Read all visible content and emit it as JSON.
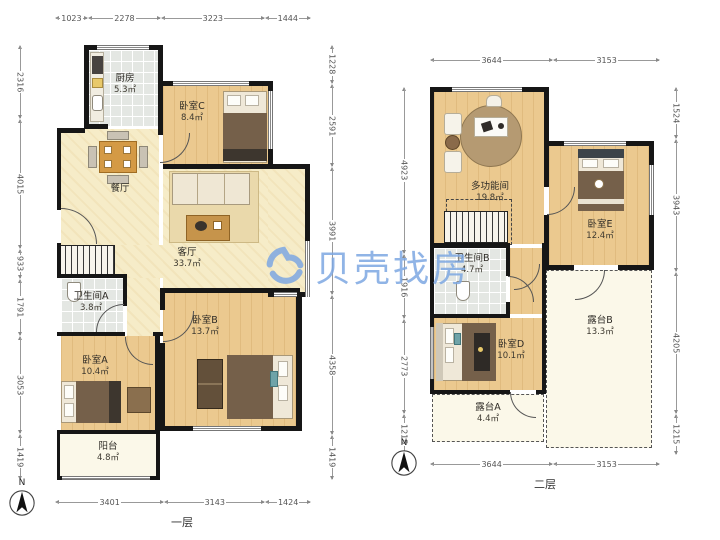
{
  "watermark": {
    "brand": "贝壳找房"
  },
  "floor1": {
    "caption": "一层",
    "compass": "N",
    "dims": {
      "top": [
        "1023",
        "2278",
        "3223",
        "1444"
      ],
      "left": [
        "2316",
        "4015",
        "933",
        "1791",
        "3053",
        "1419"
      ],
      "right": [
        "1228",
        "2591",
        "3991",
        "4358",
        "1419"
      ],
      "bottom": [
        "3401",
        "3143",
        "1424"
      ]
    },
    "rooms": {
      "kitchen": {
        "name": "厨房",
        "area": "5.3㎡"
      },
      "bedroom_c": {
        "name": "卧室C",
        "area": "8.4㎡"
      },
      "dining": {
        "name": "餐厅"
      },
      "living": {
        "name": "客厅",
        "area": "33.7㎡"
      },
      "bath_a": {
        "name": "卫生间A",
        "area": "3.8㎡"
      },
      "bedroom_a": {
        "name": "卧室A",
        "area": "10.4㎡"
      },
      "bedroom_b": {
        "name": "卧室B",
        "area": "13.7㎡"
      },
      "balcony": {
        "name": "阳台",
        "area": "4.8㎡"
      }
    }
  },
  "floor2": {
    "caption": "二层",
    "compass": "N",
    "dims": {
      "top": [
        "3644",
        "3153"
      ],
      "left": [
        "4923",
        "1916",
        "2773",
        "1215"
      ],
      "right": [
        "1524",
        "3943",
        "4205",
        "1215"
      ],
      "bottom": [
        "3644",
        "3153"
      ]
    },
    "rooms": {
      "multi": {
        "name": "多功能间",
        "area": "19.8㎡"
      },
      "bedroom_e": {
        "name": "卧室E",
        "area": "12.4㎡"
      },
      "bath_b": {
        "name": "卫生间B",
        "area": "4.7㎡"
      },
      "bedroom_d": {
        "name": "卧室D",
        "area": "10.1㎡"
      },
      "terrace_b": {
        "name": "露台B",
        "area": "13.3㎡"
      },
      "terrace_a": {
        "name": "露台A",
        "area": "4.4㎡"
      }
    }
  }
}
